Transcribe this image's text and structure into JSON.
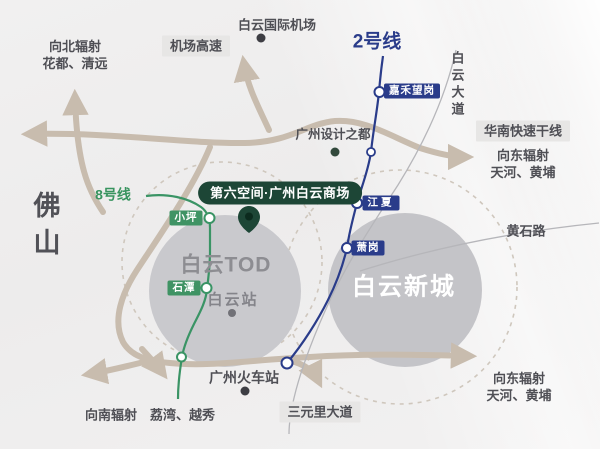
{
  "colors": {
    "line2_blue": "#2a3c8a",
    "line8_green": "#3a9465",
    "road_tan": "#c8bcae",
    "pin_green": "#1d4636",
    "zone_gray": "#c7c7cb"
  },
  "landmarks": {
    "airport": "白云国际机场",
    "design_city": "广州设计之都",
    "mall": "第六空间·广州白云商场",
    "railway_station": "广州火车站",
    "foshan": "佛山"
  },
  "zones": {
    "tod": "白云TOD",
    "baiyun_station": "白云站",
    "new_town": "白云新城"
  },
  "metro": {
    "line2": {
      "name": "2号线",
      "stations": [
        {
          "name": "嘉禾望岗"
        },
        {
          "name": "江夏"
        },
        {
          "name": "萧岗"
        }
      ]
    },
    "line8": {
      "name": "8号线",
      "stations": [
        {
          "name": "小坪"
        },
        {
          "name": "石潭"
        }
      ]
    }
  },
  "roads": {
    "airport_expressway": "机场高速",
    "south_china_expressway": "华南快速干线",
    "baiyun_avenue": "白云大道",
    "huangshi_road": "黄石路",
    "sanyuanli_avenue": "三元里大道"
  },
  "directions": {
    "north": {
      "line1": "向北辐射",
      "line2": "花都、清远"
    },
    "east_upper": {
      "line1": "向东辐射",
      "line2": "天河、黄埔"
    },
    "east_lower": {
      "line1": "向东辐射",
      "line2": "天河、黄埔"
    },
    "south": "向南辐射　荔湾、越秀"
  }
}
